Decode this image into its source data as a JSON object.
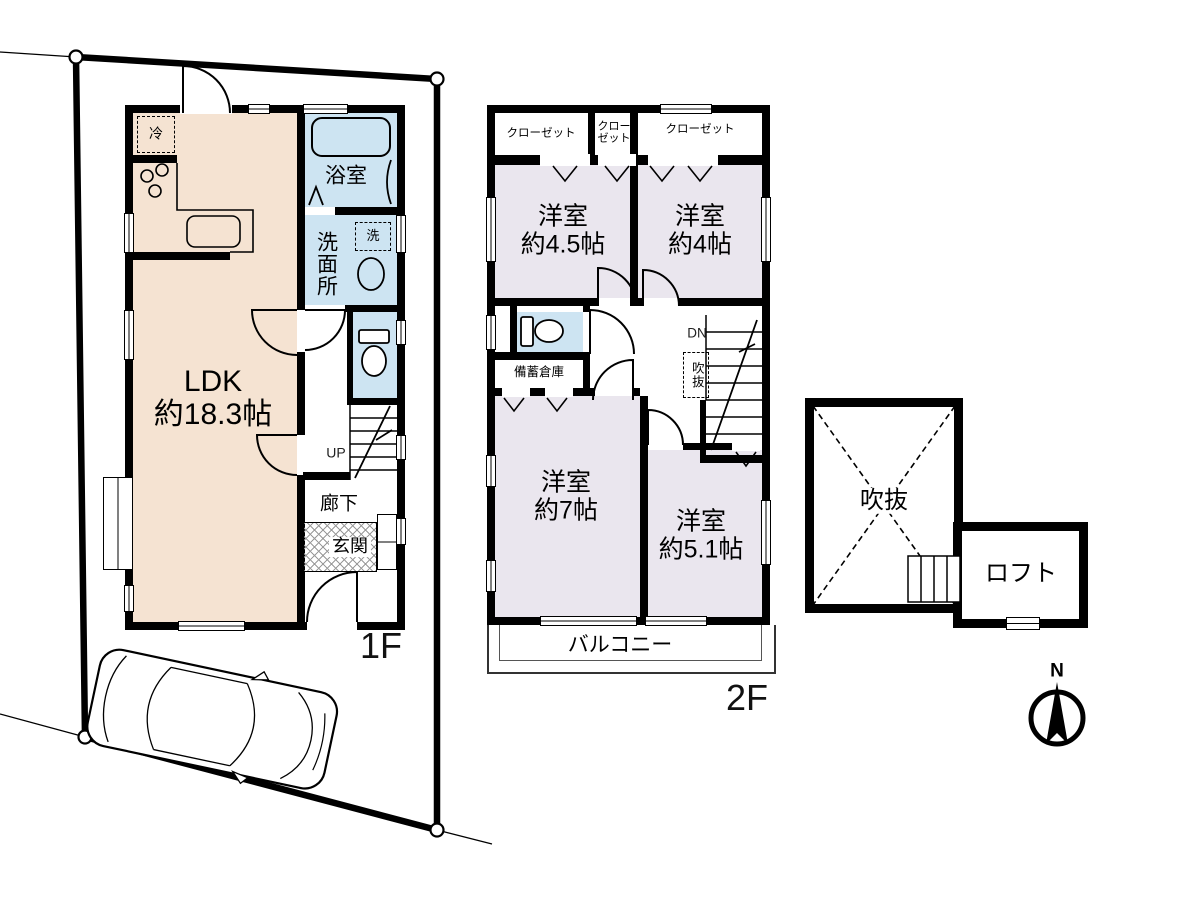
{
  "floor1": {
    "floor_label": "1F",
    "ldk_name": "LDK",
    "ldk_size": "約18.3帖",
    "bathroom": "浴室",
    "washroom": "洗面所",
    "laundry": "洗",
    "fridge": "冷",
    "stairs_up": "UP",
    "hallway": "廊下",
    "entrance": "玄関"
  },
  "floor2": {
    "floor_label": "2F",
    "closet_left": "クローゼット",
    "closet_mid": "クローゼット",
    "closet_right": "クローゼット",
    "room_a_name": "洋室",
    "room_a_size": "約4.5帖",
    "room_b_name": "洋室",
    "room_b_size": "約4帖",
    "room_c_name": "洋室",
    "room_c_size": "約7帖",
    "room_d_name": "洋室",
    "room_d_size": "約5.1帖",
    "storage": "備蓄倉庫",
    "stairs_down": "DN",
    "void_shaft": "吹抜",
    "balcony": "バルコニー"
  },
  "loft_section": {
    "void": "吹抜",
    "loft": "ロフト"
  },
  "compass": {
    "north": "N"
  },
  "colors": {
    "wall": "#000000",
    "ldk_fill": "#f5e3d2",
    "wet_area_fill": "#cde4f2",
    "bedroom_fill": "#eae6ee"
  }
}
